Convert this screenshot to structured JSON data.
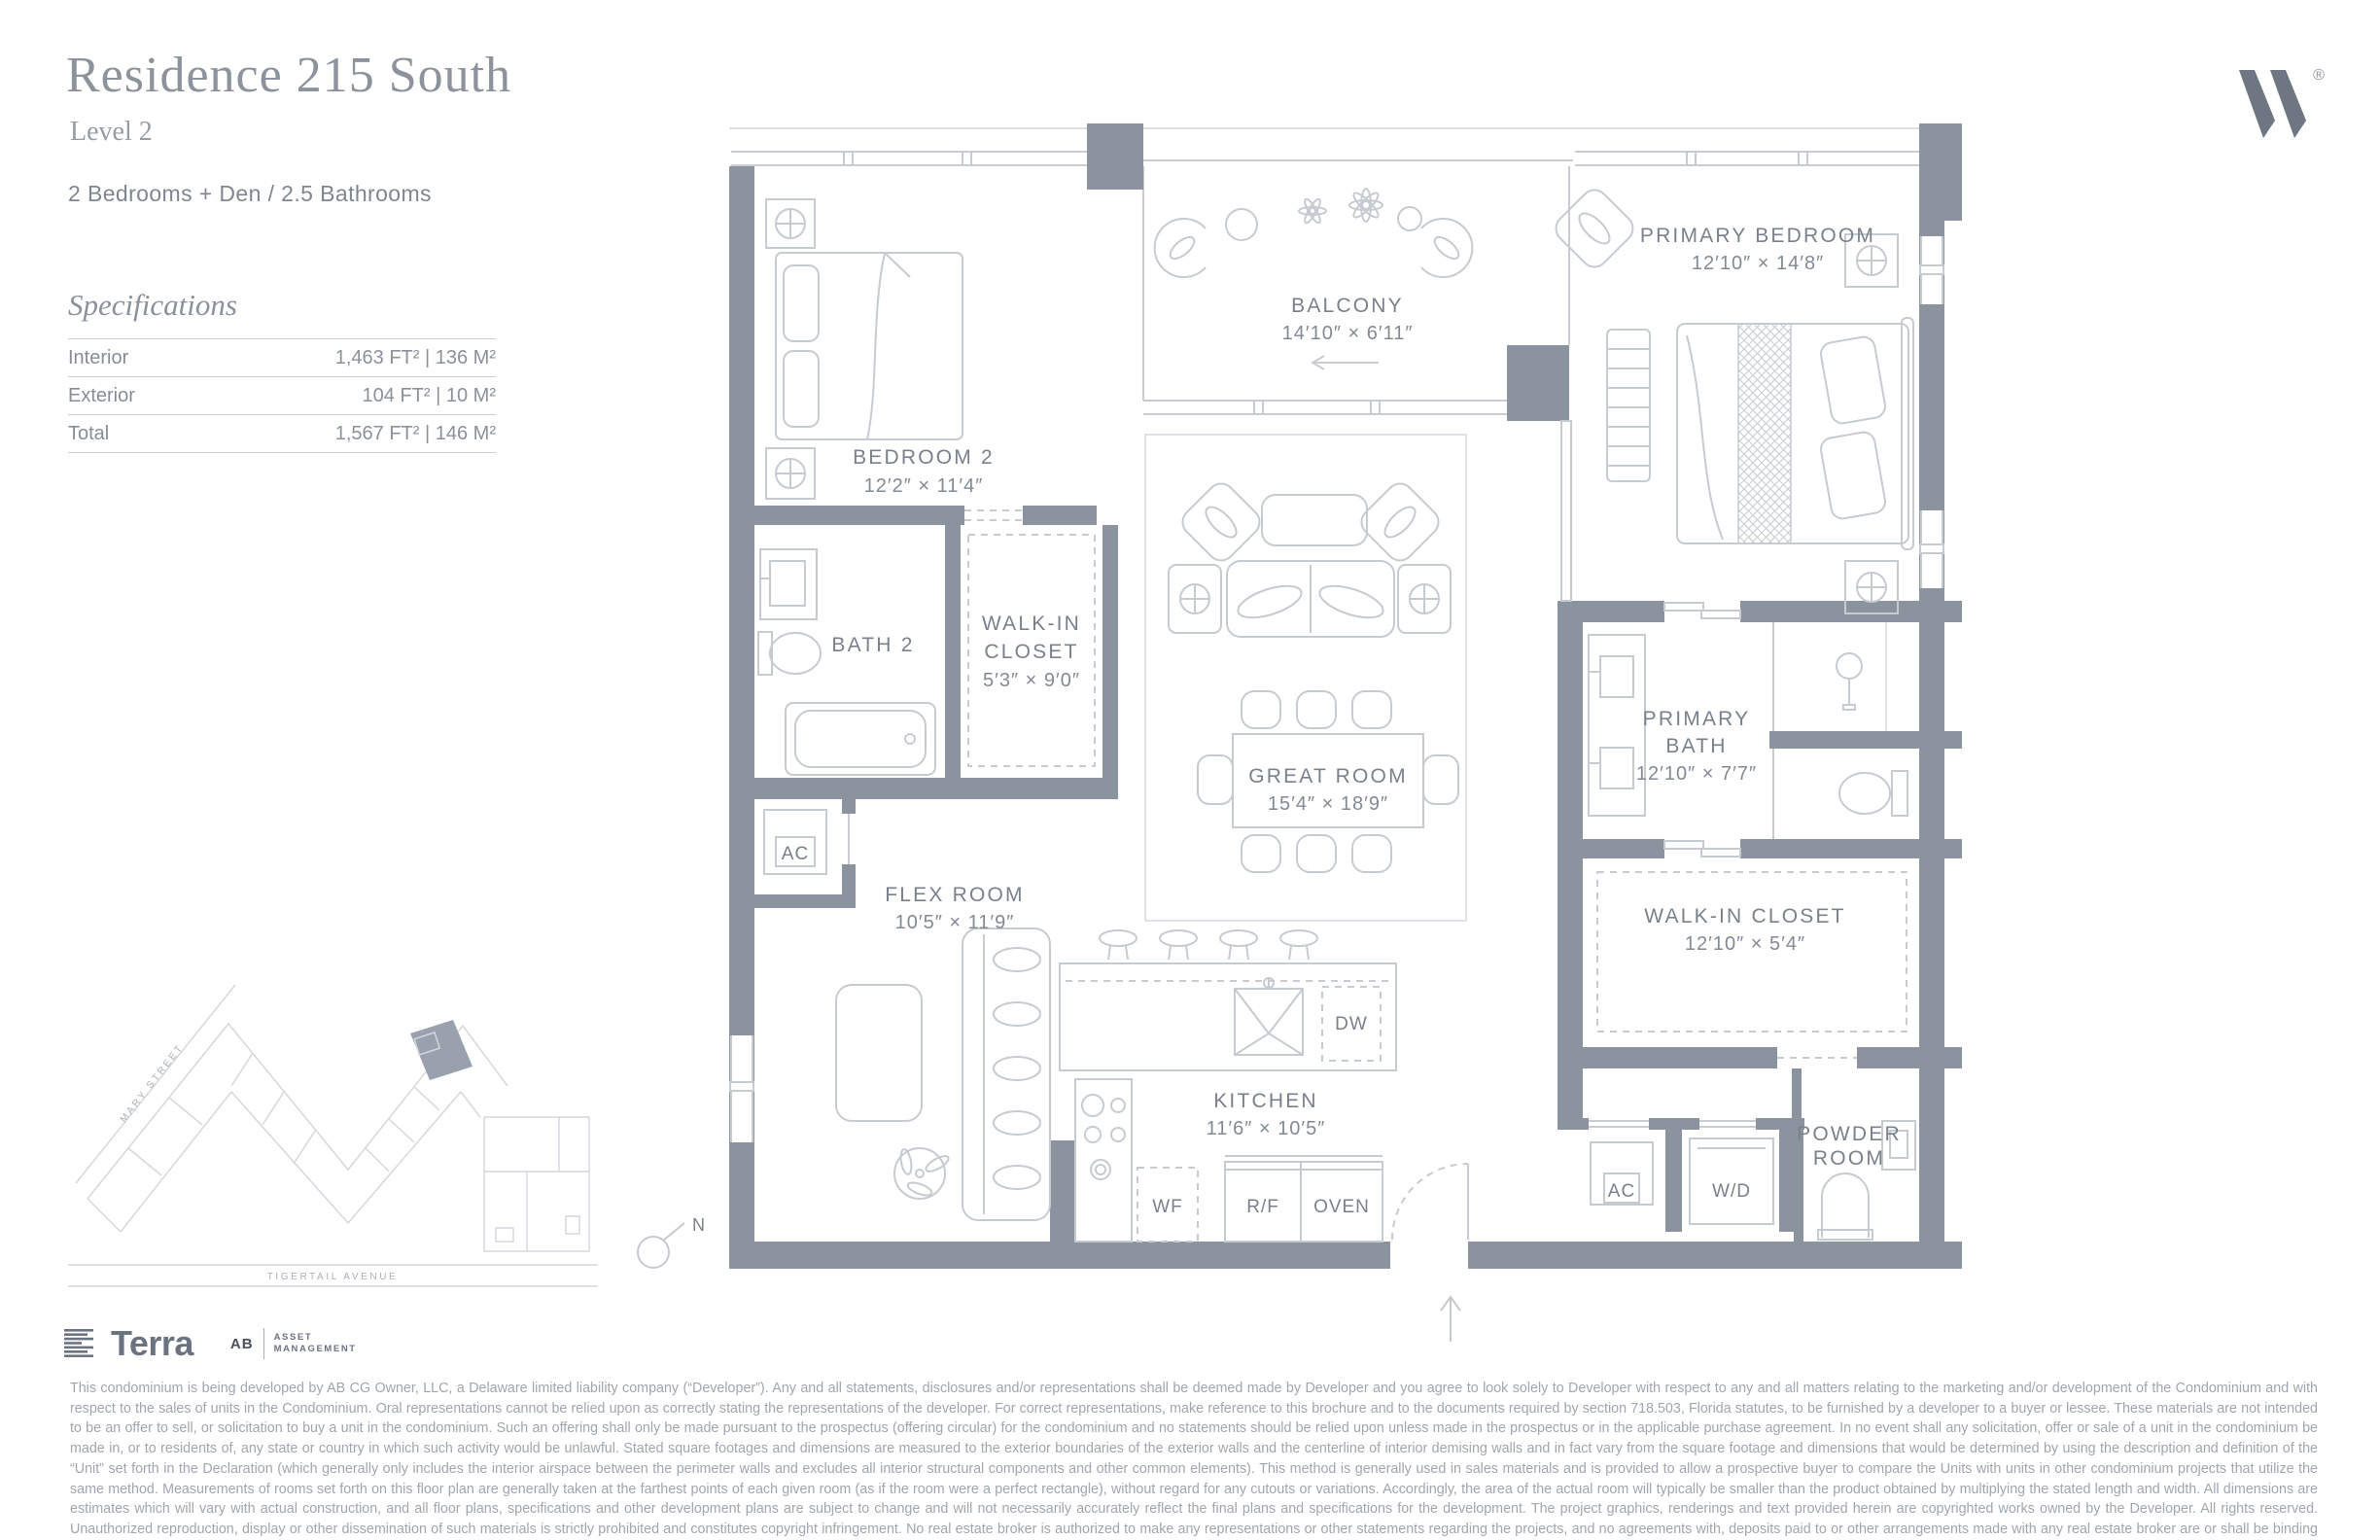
{
  "header": {
    "title": "Residence 215 South",
    "level": "Level 2",
    "program": "2 Bedrooms + Den / 2.5 Bathrooms"
  },
  "brand": {
    "registered": "®"
  },
  "specifications": {
    "heading": "Specifications",
    "rows": [
      {
        "label": "Interior",
        "value": "1,463 FT²  |  136 M²"
      },
      {
        "label": "Exterior",
        "value": "104 FT²  |  10 M²"
      },
      {
        "label": "Total",
        "value": "1,567 FT²  |  146 M²"
      }
    ]
  },
  "floor_plan": {
    "rooms": {
      "bedroom2": {
        "name": "BEDROOM 2",
        "dims": "12′2″ × 11′4″"
      },
      "balcony": {
        "name": "BALCONY",
        "dims": "14′10″ × 6′11″"
      },
      "primary_bedroom": {
        "name": "PRIMARY BEDROOM",
        "dims": "12′10″ × 14′8″"
      },
      "bath2": {
        "name": "BATH 2"
      },
      "walk_in_closet": {
        "line1": "WALK-IN",
        "line2": "CLOSET",
        "dims": "5′3″ × 9′0″"
      },
      "great_room": {
        "name": "GREAT ROOM",
        "dims": "15′4″ × 18′9″"
      },
      "primary_bath": {
        "line1": "PRIMARY",
        "line2": "BATH",
        "dims": "12′10″ × 7′7″"
      },
      "flex_room": {
        "name": "FLEX ROOM",
        "dims": "10′5″ × 11′9″"
      },
      "walk_in_closet2": {
        "name": "WALK-IN CLOSET",
        "dims": "12′10″ × 5′4″"
      },
      "kitchen": {
        "name": "KITCHEN",
        "dims": "11′6″ × 10′5″"
      },
      "powder_room": {
        "line1": "POWDER",
        "line2": "ROOM"
      }
    },
    "appliances": {
      "ac1": "AC",
      "ac2": "AC",
      "wd": "W/D",
      "dw": "DW",
      "wf": "WF",
      "rf": "R/F",
      "oven": "OVEN"
    },
    "compass": "N"
  },
  "site_map": {
    "streets": {
      "mary": "MARY STREET",
      "tigertail": "TIGERTAIL AVENUE"
    }
  },
  "footer": {
    "terra": "Terra",
    "ab": "AB",
    "asset_line1": "ASSET",
    "asset_line2": "MANAGEMENT",
    "disclaimer": "This condominium is being developed by AB CG Owner, LLC, a Delaware limited liability company (“Developer”). Any and all statements, disclosures and/or representations shall be deemed made by Developer and you agree to look solely to Developer with respect to any and all matters relating to the marketing and/or development of the Condominium and with respect to the sales of units in the Condominium. Oral representations cannot be relied upon as correctly stating the representations of the developer. For correct representations, make reference to this brochure and to the documents required by section 718.503, Florida statutes, to be furnished by a developer to a buyer or lessee. These materials are not intended to be an offer to sell, or solicitation to buy a unit in the condominium. Such an offering shall only be made pursuant to the prospectus (offering circular) for the condominium and no statements should be relied upon unless made in the prospectus or in the applicable purchase agreement. In no event shall any solicitation, offer or sale of a unit in the condominium be made in, or to residents of, any state or country in which such activity would be unlawful. Stated square footages and dimensions are measured to the exterior boundaries of the exterior walls and the centerline of interior demising walls and in fact vary from the square footage and dimensions that would be determined by using the description and definition of the “Unit” set forth in the Declaration (which generally only includes the interior airspace between the perimeter walls and excludes all interior structural components and other common elements). This method is generally used in sales materials and is provided to allow a prospective buyer to compare the Units with units in other condominium projects that utilize the same method. Measurements of rooms set forth on this floor plan are generally taken at the farthest points of each given room (as if the room were a perfect rectangle), without regard for any cutouts or variations. Accordingly, the area of the actual room will typically be smaller than the product obtained by multiplying the stated length and width. All dimensions are estimates which will vary with actual construction, and all floor plans, specifications and other development plans are subject to change and will not necessarily accurately reflect the final plans and specifications for the development. The project graphics, renderings and text provided herein are copyrighted works owned by the Developer. All rights reserved. Unauthorized reproduction, display or other dissemination of such materials is strictly prohibited and constitutes copyright infringement. No real estate broker is authorized to make any representations or other statements regarding the projects, and no agreements with, deposits paid to or other arrangements made with any real estate broker are or shall be binding on the Developer. Equal housing opportunity."
  },
  "colors": {
    "wall": "#8B939F",
    "line": "#C9CDD3",
    "label": "#79818C",
    "brand": "#6E7681"
  }
}
